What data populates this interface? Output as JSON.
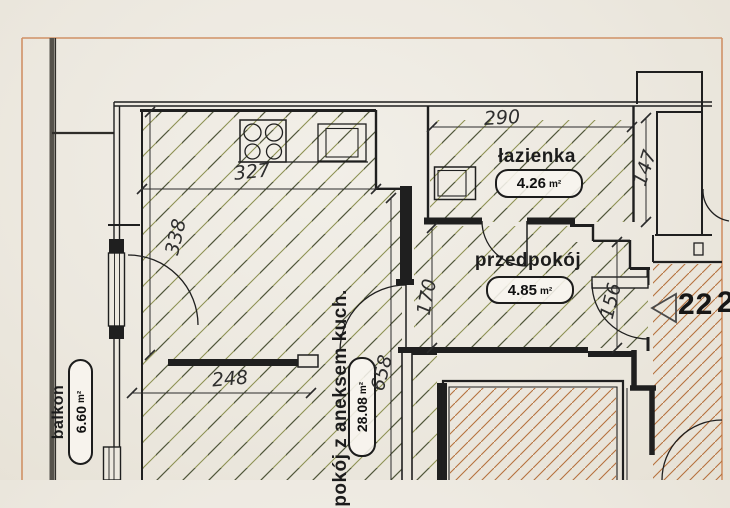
{
  "rooms": {
    "pokoj": {
      "name": "pokój z aneksem kuch.",
      "area": "28.08",
      "unit": "m²"
    },
    "lazienka": {
      "name": "łazienka",
      "area": "4.26",
      "unit": "m²"
    },
    "przedpokoj": {
      "name": "przedpokój",
      "area": "4.85",
      "unit": "m²"
    },
    "balkon": {
      "name": "balkon",
      "area": "6.60",
      "unit": "m²"
    }
  },
  "dimensions": {
    "d290": "290",
    "d147": "147",
    "d327": "327",
    "d338": "338",
    "d248": "248",
    "d658": "658",
    "d170": "170",
    "d156": "156"
  },
  "corridor": {
    "unit_number": "22",
    "adjacent_digit": "2"
  },
  "icons": {
    "stove": "stove-icon",
    "sink": "sink-icon",
    "washing_machine": "washing-machine-icon",
    "entrance_arrow": "entrance-arrow-icon"
  },
  "colors": {
    "apartment_hatch_dark": "#50563a",
    "apartment_hatch_light": "#8d9153",
    "neighbor_hatch": "#b5713d",
    "plan_border": "#d09166",
    "wall": "#1f1f1f",
    "paper": "#ece8df",
    "railing": "#55524b"
  }
}
